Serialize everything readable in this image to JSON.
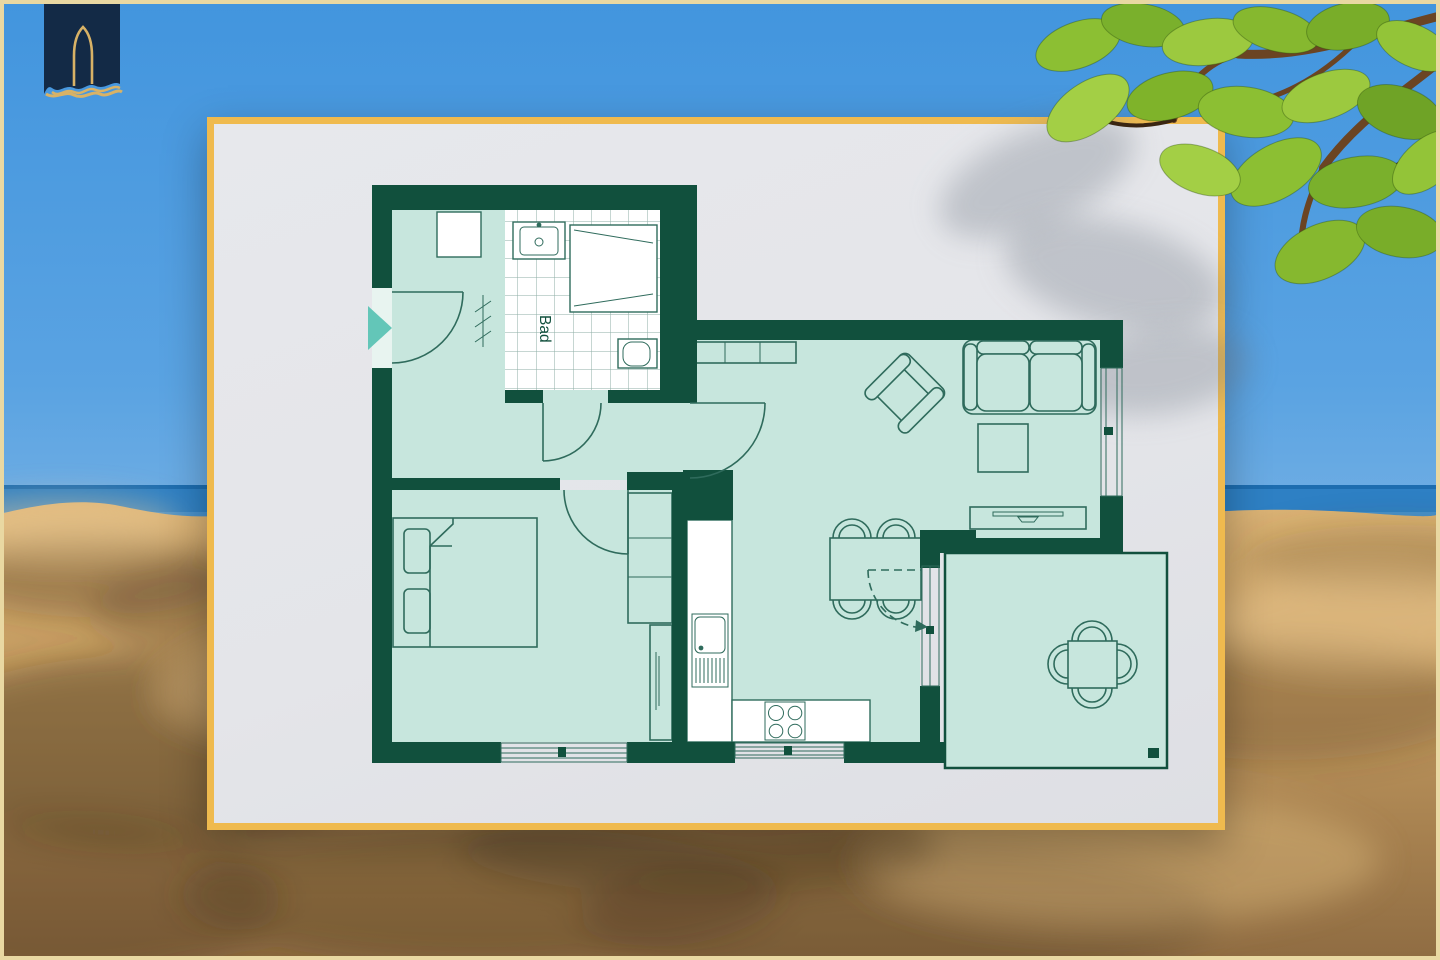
{
  "colors": {
    "sky_top": "#4295de",
    "sky_mid": "#5aa3e2",
    "sky_low": "#aacbe9",
    "sea": "#2e80c4",
    "sea_deep": "#1d6db0",
    "sand_light": "#d7ae6e",
    "sand_dark": "#8f6c42",
    "frame": "#e9d8a2",
    "card_border": "#efba4e",
    "card_bg": "#e4e5e9",
    "wall": "#11503d",
    "room": "#c7e6dd",
    "line": "#2f6b5c",
    "fixture_white": "#ffffff",
    "arrow": "#63c6b8",
    "logo_navy": "#132a46",
    "logo_gold": "#d8b266",
    "branch": "#6b4423"
  },
  "plan": {
    "bathroom_label": "Bad"
  }
}
